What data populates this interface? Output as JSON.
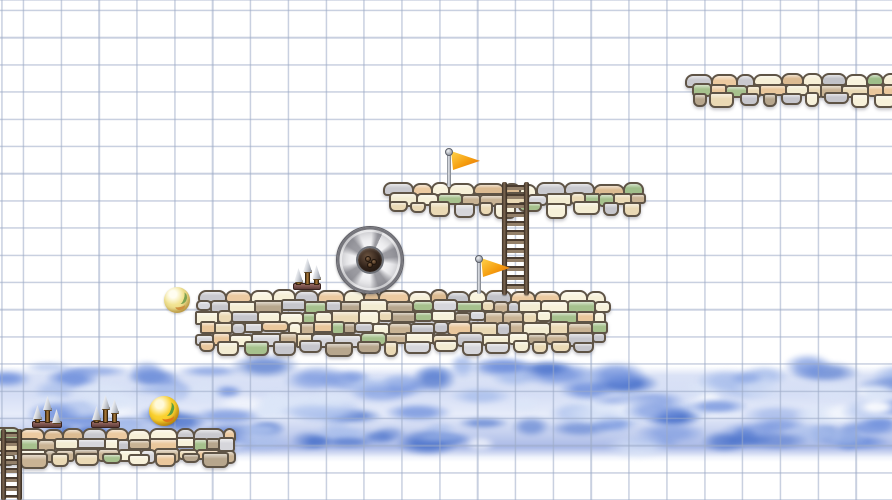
{
  "app": {
    "title": "doodle-platformer-level",
    "type": "2D platformer game scene on graph paper"
  },
  "canvas": {
    "width": 892,
    "height": 500
  },
  "background": {
    "paper_color": "#ffffff",
    "grid": {
      "line_color": "rgba(156,170,198,0.55)",
      "cell_width": 37.85,
      "cell_height": 27.2,
      "offset_x": 22.7,
      "offset_y": 9.7,
      "line_thickness": 1.6
    }
  },
  "cloud_band": {
    "top": 366,
    "height": 96,
    "seed": 7,
    "puff_colors": {
      "dark": "#4d74cc",
      "mid": "#7292dd",
      "light": "#aabfec",
      "pale": "#dce6f8",
      "white": "#ffffff"
    }
  },
  "stone_palette": {
    "top_row": [
      "#f6efd7",
      "#eccaa1",
      "#c9c9cf",
      "#9fbe8a",
      "#f9f3dd",
      "#dcbb92",
      "#c2c3c9"
    ],
    "body": [
      "#f3ecd2",
      "#eac79c",
      "#c6c6cc",
      "#a6c18d",
      "#b7a68d",
      "#ead9b5",
      "#d6d6db",
      "#c9b394",
      "#f7f1da"
    ],
    "grout": "#5f5446"
  },
  "platforms": [
    {
      "name": "platform-top-right",
      "x": 687,
      "y": 73,
      "width": 210,
      "height": 32,
      "seed": 101
    },
    {
      "name": "platform-upper",
      "x": 385,
      "y": 182,
      "width": 258,
      "height": 32,
      "seed": 202
    },
    {
      "name": "platform-main",
      "x": 197,
      "y": 289,
      "width": 409,
      "height": 64,
      "seed": 303
    },
    {
      "name": "platform-bottom-left",
      "x": -8,
      "y": 427,
      "width": 239,
      "height": 38,
      "seed": 404
    }
  ],
  "ladders": [
    {
      "name": "ladder-middle",
      "x": 502,
      "y": 182,
      "width": 27,
      "height": 113
    },
    {
      "name": "ladder-bottom-left",
      "x": 1,
      "y": 429,
      "width": 21,
      "height": 71
    }
  ],
  "flags": [
    {
      "name": "flag-upper",
      "x": 447,
      "y": 148,
      "pole_height": 35,
      "flag_colors": [
        "#ffd44d",
        "#f59d0e",
        "#e06a10"
      ]
    },
    {
      "name": "flag-lower",
      "x": 477,
      "y": 255,
      "pole_height": 35,
      "flag_colors": [
        "#ffd44d",
        "#f59d0e",
        "#e06a10"
      ]
    }
  ],
  "spike_groups": [
    {
      "name": "spikes-main-platform",
      "x": 293,
      "bottom_y": 290,
      "width": 28,
      "spikes": [
        {
          "dx": 1,
          "h": 17
        },
        {
          "dx": 10,
          "h": 27
        },
        {
          "dx": 19,
          "h": 20
        }
      ]
    },
    {
      "name": "spikes-left-a",
      "x": 32,
      "bottom_y": 428,
      "width": 30,
      "spikes": [
        {
          "dx": 1,
          "h": 18
        },
        {
          "dx": 11,
          "h": 27
        },
        {
          "dx": 20,
          "h": 14
        }
      ]
    },
    {
      "name": "spikes-left-b",
      "x": 91,
      "bottom_y": 428,
      "width": 29,
      "spikes": [
        {
          "dx": 1,
          "h": 17
        },
        {
          "dx": 10,
          "h": 28
        },
        {
          "dx": 19,
          "h": 24
        }
      ]
    }
  ],
  "balls": [
    {
      "name": "ball-pale-yellow",
      "cx": 177,
      "cy": 300,
      "radius": 13,
      "colors": {
        "highlight": "#fffdf0",
        "body": "#f2e492",
        "shade": "#cfa94e",
        "mark_green": "#7fa351",
        "mark_orange": "#cf8f3e"
      }
    },
    {
      "name": "ball-golden",
      "cx": 164,
      "cy": 411,
      "radius": 15,
      "colors": {
        "highlight": "#fff9d8",
        "body": "#fbd12e",
        "shade": "#c8860a",
        "mark_green": "#5f9e3f",
        "mark_orange": "#e07818"
      }
    }
  ],
  "wheel": {
    "name": "spinning-wheel",
    "cx": 369,
    "cy": 259,
    "radius": 33,
    "hub_radius": 12,
    "colors": {
      "blade_light": "#f2f2f4",
      "blade_dark": "#9c9ca2",
      "hub": "#2e2018",
      "rim": "#76767c"
    }
  }
}
